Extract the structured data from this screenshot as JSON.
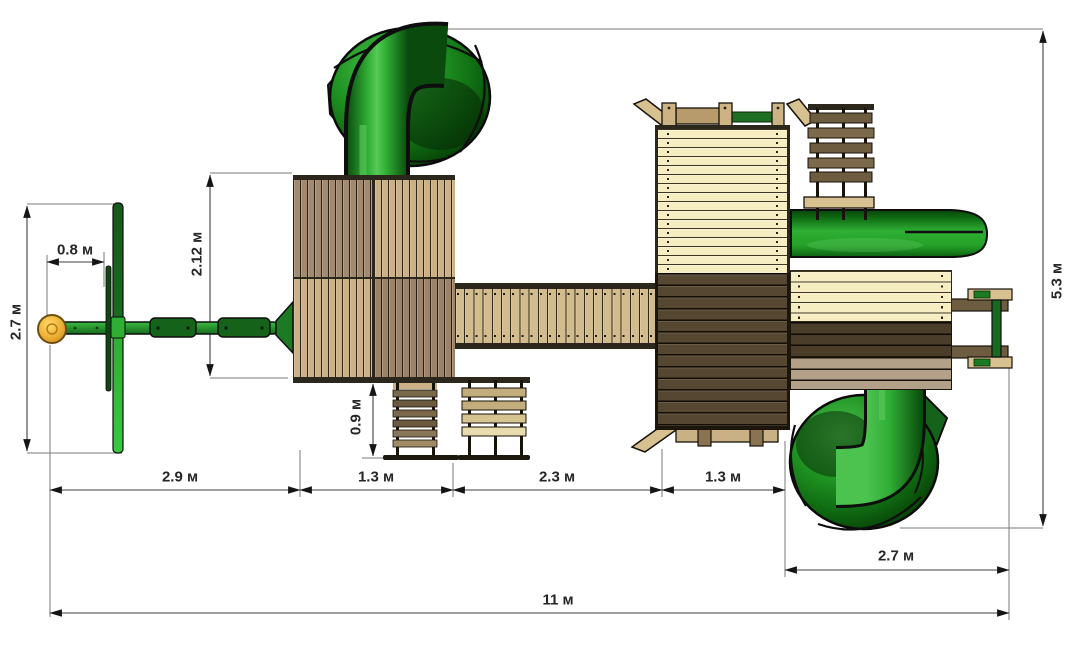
{
  "diagram": {
    "type": "playground-top-view-dimension-plan",
    "unit": "м",
    "dims": {
      "swing_offset": "0.8 м",
      "swing_depth": "2.7 м",
      "tower_depth": "2.12 м",
      "ladder_depth": "0.9 м",
      "seg_swing_span": "2.9 м",
      "seg_left_tower": "1.3 м",
      "seg_bridge": "2.3 м",
      "seg_right_tower": "1.3 м",
      "seg_slide_zone": "2.7 м",
      "total_width": "11 м",
      "total_depth": "5.3 м"
    },
    "components": [
      "swing-beam",
      "tire-swing-seat",
      "swing-crossbar",
      "spiral-tube-slide-top",
      "spiral-tube-slide-bottom",
      "left-tower",
      "bridge",
      "right-tower",
      "straight-slide",
      "ladder",
      "climbing-wall-lower",
      "climbing-wall-upper",
      "picnic-rail",
      "entry-handles"
    ],
    "colors": {
      "slide_green_bright": "#2fae34",
      "slide_green_dark": "#0a4a0d",
      "swing_green": "#1d7a24",
      "seat_yellow": "#eda929",
      "wood_tan": "#cbb185",
      "wood_cream": "#f6eec2",
      "wood_mauve": "#a28a70",
      "wood_dark": "#554732",
      "wood_taupe": "#b2a088",
      "outline": "#17120a",
      "dim_line": "#3f3f3f",
      "dim_text": "#262626",
      "background": "#ffffff"
    }
  }
}
